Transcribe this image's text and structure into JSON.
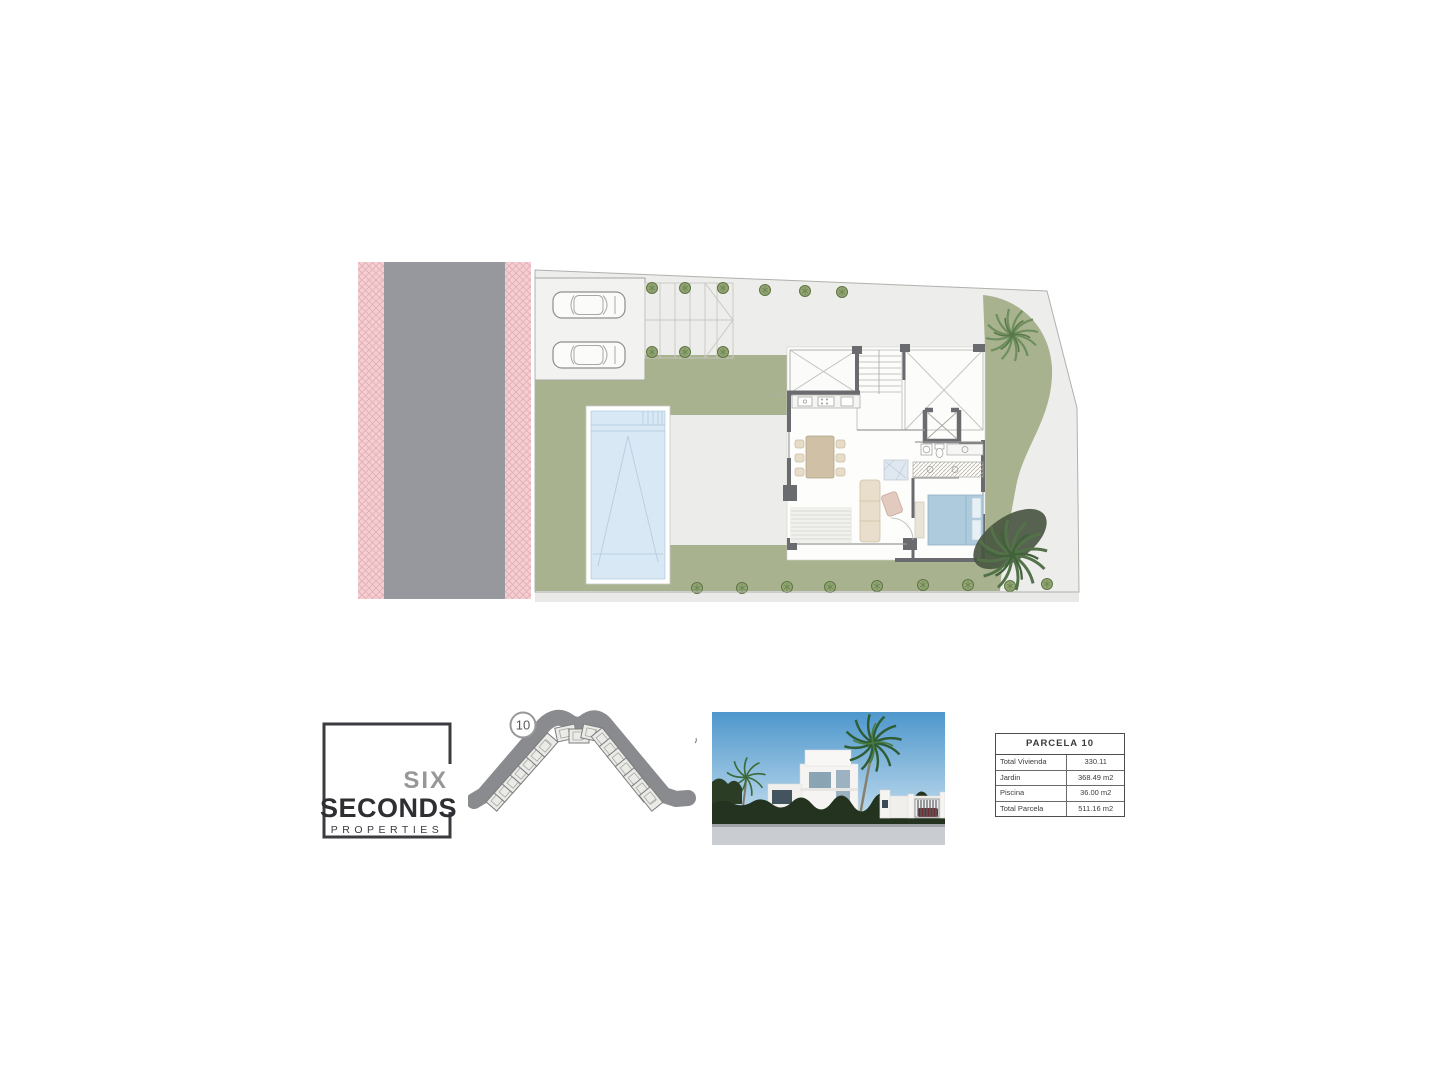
{
  "logo": {
    "line1": "SIX",
    "line2": "SECONDS",
    "line3": "PROPERTIES"
  },
  "location_map": {
    "badge": "10"
  },
  "parcel_table": {
    "title": "PARCELA 10",
    "rows": [
      {
        "label": "Total Vivienda",
        "value": "330.11"
      },
      {
        "label": "Jardin",
        "value": "368.49 m2"
      },
      {
        "label": "Piscina",
        "value": "36.00 m2"
      },
      {
        "label": "Total Parcela",
        "value": "511.16 m2"
      }
    ]
  },
  "site_plan": {
    "colors": {
      "sidewalk_pink": "#f4ced2",
      "road_gray": "#97989d",
      "plot_gray": "#ededeb",
      "garden_green": "#a9b28f",
      "pool_blue": "#d9e8f5",
      "wall_dark": "#6a6b6f",
      "furniture_tan": "#cfc0a6",
      "bed_blue": "#aecbdd",
      "palm_green": "#6e8f5d",
      "hedge_dark": "#243320",
      "sky_blue": "#4e97cc",
      "logo_dark": "#2e2e33",
      "logo_gray": "#97979a"
    }
  }
}
